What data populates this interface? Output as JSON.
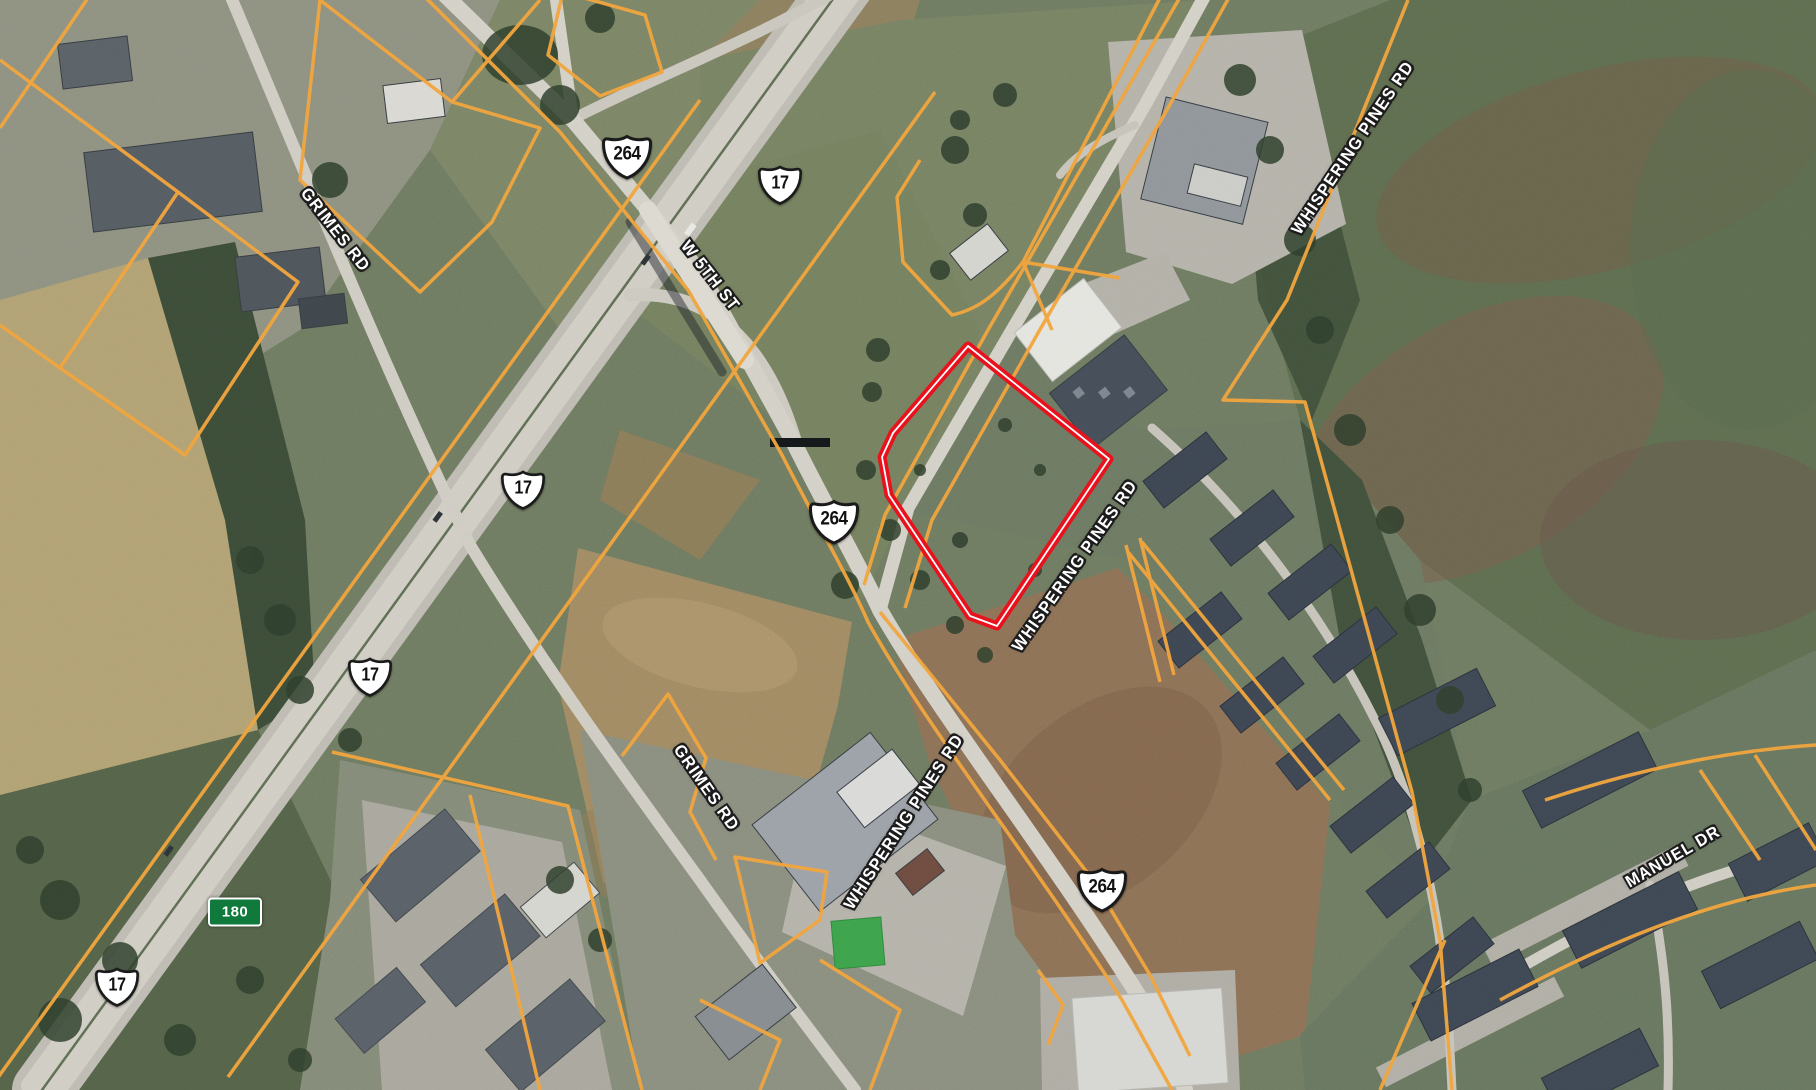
{
  "map": {
    "type": "satellite-parcel-map",
    "road_labels": [
      {
        "id": "grimes-rd-top",
        "text": "GRIMES RD"
      },
      {
        "id": "w-5th-st",
        "text": "W 5TH ST"
      },
      {
        "id": "whispering-pines-rd-top",
        "text": "WHISPERING PINES RD"
      },
      {
        "id": "whispering-pines-rd-middle",
        "text": "WHISPERING PINES RD"
      },
      {
        "id": "whispering-pines-rd-bottom",
        "text": "WHISPERING PINES RD"
      },
      {
        "id": "grimes-rd-bottom",
        "text": "GRIMES RD"
      },
      {
        "id": "manuel-dr",
        "text": "MANUEL DR"
      }
    ],
    "route_shields": [
      {
        "id": "us-264-top",
        "route": "264",
        "style": "us-highway-shield"
      },
      {
        "id": "us-17-top",
        "route": "17",
        "style": "us-highway-shield"
      },
      {
        "id": "us-17-middle",
        "route": "17",
        "style": "us-highway-shield"
      },
      {
        "id": "us-264-middle",
        "route": "264",
        "style": "us-highway-shield"
      },
      {
        "id": "us-17-lower",
        "route": "17",
        "style": "us-highway-shield"
      },
      {
        "id": "us-17-bottom",
        "route": "17",
        "style": "us-highway-shield"
      },
      {
        "id": "us-264-bottom",
        "route": "264",
        "style": "us-highway-shield"
      },
      {
        "id": "route-180",
        "route": "180",
        "style": "green-rect-marker"
      }
    ],
    "highlighted_parcel": {
      "outline_color": "#e8111c",
      "inner_line_color": "#ffffff"
    },
    "colors": {
      "parcel_boundary": "#f2a33c",
      "road_fill": "#d3d0c7",
      "shield_fill": "#ffffff",
      "shield_outline": "#1a1a1a",
      "green_marker_fill": "#0f7a3c",
      "label_text": "#ffffff",
      "label_halo": "#1c1c1c"
    }
  }
}
